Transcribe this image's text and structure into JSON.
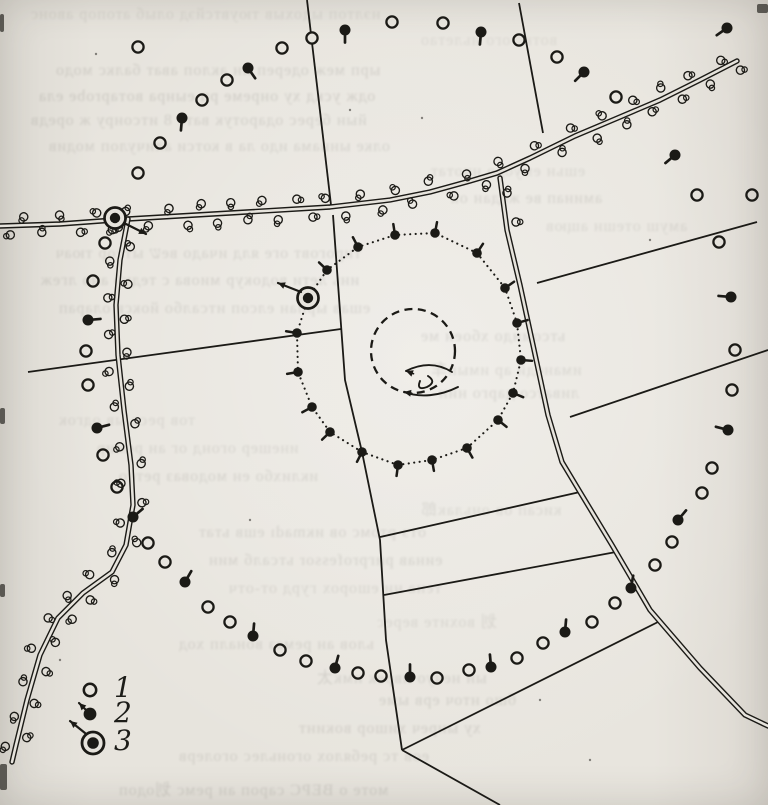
{
  "figure": {
    "kind": "scanned hand-drawn tracking sketch map on book page",
    "ink_color": "#1b1a16",
    "paper_color": "#e6e3dc"
  },
  "legend": {
    "items": [
      {
        "label": "1",
        "symbol": "open-circle"
      },
      {
        "label": "2",
        "symbol": "filled-dot-with-tail"
      },
      {
        "label": "3",
        "symbol": "double-circle-with-arrow"
      }
    ],
    "marks": {
      "circle1": [
        90,
        690
      ],
      "dot2": [
        90,
        714
      ],
      "dot2_tail": [
        79,
        703
      ],
      "bull3": [
        93,
        743
      ],
      "bull3_arrow": [
        [
          85,
          733
        ],
        [
          70,
          721
        ]
      ]
    }
  },
  "map": {
    "roads": [
      {
        "name": "main-road",
        "shrubs": true,
        "points": [
          [
            0,
            226
          ],
          [
            60,
            224
          ],
          [
            128,
            219
          ],
          [
            230,
            213
          ],
          [
            330,
            207
          ],
          [
            390,
            200
          ],
          [
            430,
            192
          ],
          [
            470,
            181
          ],
          [
            497,
            173
          ],
          [
            530,
            158
          ],
          [
            575,
            136
          ],
          [
            620,
            117
          ],
          [
            660,
            100
          ],
          [
            700,
            80
          ],
          [
            737,
            61
          ]
        ]
      },
      {
        "name": "left-road",
        "shrubs": true,
        "points": [
          [
            128,
            219
          ],
          [
            120,
            260
          ],
          [
            116,
            305
          ],
          [
            118,
            355
          ],
          [
            124,
            410
          ],
          [
            131,
            465
          ],
          [
            133,
            505
          ],
          [
            126,
            545
          ],
          [
            112,
            572
          ],
          [
            83,
            593
          ],
          [
            58,
            618
          ],
          [
            40,
            655
          ],
          [
            27,
            700
          ],
          [
            16,
            745
          ],
          [
            12,
            762
          ]
        ]
      },
      {
        "name": "south-road",
        "shrubs": false,
        "points": [
          [
            500,
            178
          ],
          [
            507,
            230
          ],
          [
            520,
            285
          ],
          [
            533,
            345
          ],
          [
            548,
            415
          ],
          [
            562,
            462
          ],
          [
            580,
            492
          ],
          [
            612,
            545
          ],
          [
            650,
            610
          ],
          [
            700,
            668
          ],
          [
            745,
            715
          ],
          [
            768,
            726
          ]
        ]
      }
    ],
    "extra_shrubs": [
      [
        507,
        193
      ],
      [
        516,
        222
      ]
    ],
    "boundaries": [
      [
        [
          307,
          0
        ],
        [
          331,
          205
        ]
      ],
      [
        [
          333,
          215
        ],
        [
          345,
          380
        ],
        [
          362,
          452
        ],
        [
          380,
          540
        ],
        [
          386,
          640
        ],
        [
          402,
          750
        ]
      ],
      [
        [
          519,
          3
        ],
        [
          543,
          133
        ]
      ],
      [
        [
          28,
          372
        ],
        [
          341,
          329
        ]
      ],
      [
        [
          537,
          283
        ],
        [
          757,
          222
        ]
      ],
      [
        [
          570,
          417
        ],
        [
          768,
          350
        ]
      ],
      [
        [
          380,
          537
        ],
        [
          580,
          492
        ]
      ],
      [
        [
          384,
          595
        ],
        [
          616,
          552
        ]
      ],
      [
        [
          402,
          750
        ],
        [
          658,
          622
        ]
      ],
      [
        [
          402,
          750
        ],
        [
          500,
          805
        ]
      ]
    ],
    "open_circles": [
      [
        138,
        47
      ],
      [
        282,
        48
      ],
      [
        392,
        22
      ],
      [
        443,
        23
      ],
      [
        227,
        80
      ],
      [
        202,
        100
      ],
      [
        160,
        143
      ],
      [
        138,
        173
      ],
      [
        557,
        57
      ],
      [
        616,
        97
      ],
      [
        697,
        195
      ],
      [
        752,
        195
      ],
      [
        719,
        242
      ],
      [
        735,
        350
      ],
      [
        732,
        390
      ],
      [
        712,
        468
      ],
      [
        702,
        493
      ],
      [
        672,
        542
      ],
      [
        655,
        565
      ],
      [
        615,
        603
      ],
      [
        592,
        622
      ],
      [
        543,
        643
      ],
      [
        517,
        658
      ],
      [
        469,
        670
      ],
      [
        437,
        678
      ],
      [
        381,
        676
      ],
      [
        358,
        673
      ],
      [
        306,
        661
      ],
      [
        280,
        650
      ],
      [
        230,
        622
      ],
      [
        208,
        607
      ],
      [
        165,
        562
      ],
      [
        148,
        543
      ],
      [
        117,
        487
      ],
      [
        103,
        455
      ],
      [
        88,
        385
      ],
      [
        86,
        351
      ],
      [
        93,
        281
      ],
      [
        105,
        243
      ]
    ],
    "line_circles": [
      [
        312,
        38
      ],
      [
        519,
        40
      ]
    ],
    "marked_trees": [
      [
        182,
        118,
        95
      ],
      [
        248,
        68,
        55
      ],
      [
        345,
        30,
        90
      ],
      [
        481,
        32,
        95
      ],
      [
        584,
        72,
        135
      ],
      [
        675,
        155,
        140
      ],
      [
        727,
        28,
        145
      ],
      [
        731,
        297,
        185
      ],
      [
        728,
        430,
        195
      ],
      [
        678,
        520,
        310
      ],
      [
        631,
        588,
        280
      ],
      [
        565,
        632,
        275
      ],
      [
        491,
        667,
        265
      ],
      [
        410,
        677,
        270
      ],
      [
        335,
        668,
        285
      ],
      [
        253,
        636,
        275
      ],
      [
        185,
        582,
        300
      ],
      [
        133,
        517,
        320
      ],
      [
        97,
        428,
        345
      ],
      [
        88,
        320,
        355
      ]
    ],
    "loop": {
      "center": [
        413,
        352
      ],
      "dots": [
        [
          327,
          270
        ],
        [
          358,
          247
        ],
        [
          395,
          235
        ],
        [
          435,
          233
        ],
        [
          477,
          253
        ],
        [
          505,
          288
        ],
        [
          517,
          323
        ],
        [
          521,
          360
        ],
        [
          513,
          393
        ],
        [
          498,
          420
        ],
        [
          467,
          448
        ],
        [
          432,
          460
        ],
        [
          398,
          465
        ],
        [
          362,
          452
        ],
        [
          330,
          432
        ],
        [
          312,
          407
        ],
        [
          298,
          372
        ],
        [
          297,
          333
        ]
      ]
    },
    "dashed_circle": {
      "cx": 413,
      "cy": 351,
      "r": 42
    },
    "scribble": [
      "M452,372 C436,362 420,364 406,371",
      "M458,387 C440,396 420,398 404,392",
      "M428,376 q9,6 -1,11 q-11,4 -7,-6"
    ],
    "scribble_heads": [
      [
        406,
        371,
        200
      ],
      [
        404,
        392,
        190
      ]
    ],
    "bullseyes": [
      {
        "x": 115,
        "y": 218,
        "arrow": [
          [
            124,
            223
          ],
          [
            146,
            234
          ]
        ]
      },
      {
        "x": 308,
        "y": 298,
        "arrow": [
          [
            301,
            292
          ],
          [
            278,
            283
          ]
        ]
      }
    ],
    "smudges": [
      [
        0,
        14,
        4,
        18
      ],
      [
        0,
        408,
        5,
        16
      ],
      [
        0,
        584,
        5,
        13
      ],
      [
        757,
        4,
        11,
        9
      ],
      [
        0,
        764,
        7,
        26
      ]
    ],
    "specks": [
      [
        96,
        54
      ],
      [
        422,
        118
      ],
      [
        650,
        240
      ],
      [
        250,
        520
      ],
      [
        540,
        700
      ],
      [
        60,
        660
      ],
      [
        350,
        110
      ],
      [
        590,
        760
      ]
    ]
  },
  "ghost_lines": [
    {
      "y": 6,
      "x": 30,
      "o": 0.09,
      "t": "нэлтоп ыдохыв тюувтсйэд олыб атопор авонс"
    },
    {
      "y": 32,
      "x": 420,
      "o": 0.08,
      "t": "вотке ого ньлетао"
    },
    {
      "y": 62,
      "x": 55,
      "o": 0.13,
      "t": "ырп меж одереп ин аклоп ават балкс модо"
    },
    {
      "y": 88,
      "x": 38,
      "o": 0.14,
      "t": "одж ускд ху онреме рп еынра вотаprobe ела"
    },
    {
      "y": 112,
      "x": 30,
      "o": 0.13,
      "t": "йын берес одаротук ватс 8 итсонру ж оредв"
    },
    {
      "y": 138,
      "x": 48,
      "o": 0.12,
      "t": "олке ыннама идо ла в котси аличулоп модив"
    },
    {
      "y": 163,
      "x": 430,
      "o": 0.1,
      "t": "ешьн емуодо нчотат"
    },
    {
      "y": 190,
      "x": 450,
      "o": 0.12,
      "t": "аминап ве жодан ок"
    },
    {
      "y": 218,
      "x": 545,
      "o": 0.1,
      "t": "амуш отешн ащюв"
    },
    {
      "y": 245,
      "x": 55,
      "o": 0.12,
      "t": "тироговт оге ялд ичадо веש ытсор тюач"
    },
    {
      "y": 272,
      "x": 40,
      "o": 0.13,
      "t": "инь лети водокур миова с тедуб ано лгеж"
    },
    {
      "y": 300,
      "x": 58,
      "o": 0.12,
      "t": "ешав ырпан елсоп итсалбо йоксв оларап"
    },
    {
      "y": 328,
      "x": 420,
      "o": 0.12,
      "t": "ьтсомидо хбоен ме"
    },
    {
      "y": 356,
      "x": 430,
      "o": 0.11,
      "t": "иманодй ар имын车"
    },
    {
      "y": 385,
      "x": 438,
      "o": 0.12,
      "t": "ливатсо дарго нин"
    },
    {
      "y": 412,
      "x": 58,
      "o": 0.1,
      "t": "тов ресс ыв одгок"
    },
    {
      "y": 440,
      "x": 96,
      "o": 0.11,
      "t": "инешер огонд ог ан ремир"
    },
    {
      "y": 468,
      "x": 118,
      "o": 0.12,
      "t": "иклихбо ен модоваз ретсо"
    },
    {
      "y": 496,
      "x": 420,
      "o": 0.1,
      "t": "кисап ов оньлак郎"
    },
    {
      "y": 524,
      "x": 198,
      "o": 0.12,
      "t": "отэ ртомс ов икmadı ешв ьтат"
    },
    {
      "y": 552,
      "x": 208,
      "o": 0.12,
      "t": "еинав ригprofessor ьтсалб мин"
    },
    {
      "y": 580,
      "x": 228,
      "o": 0.11,
      "t": "тена ни ешорох гурд от-отч"
    },
    {
      "y": 608,
      "x": 376,
      "o": 0.1,
      "t": "划 вохите верес"
    },
    {
      "y": 636,
      "x": 178,
      "o": 0.12,
      "t": "ьлов ан ремаз воналп ход"
    },
    {
      "y": 664,
      "x": 316,
      "o": 0.12,
      "t": "ын нечуо пврек имк太"
    },
    {
      "y": 692,
      "x": 378,
      "o": 0.13,
      "t": "бшо нточ ерв ыме"
    },
    {
      "y": 720,
      "x": 298,
      "o": 0.13,
      "t": "ху ынреч хишор вокинт"
    },
    {
      "y": 748,
      "x": 178,
      "o": 0.12,
      "t": "еов тс ребялох огоньлес оголерв"
    },
    {
      "y": 776,
      "x": 118,
      "o": 0.13,
      "t": "моте о ВЕРС сароп ан ремс 划одоп"
    }
  ]
}
